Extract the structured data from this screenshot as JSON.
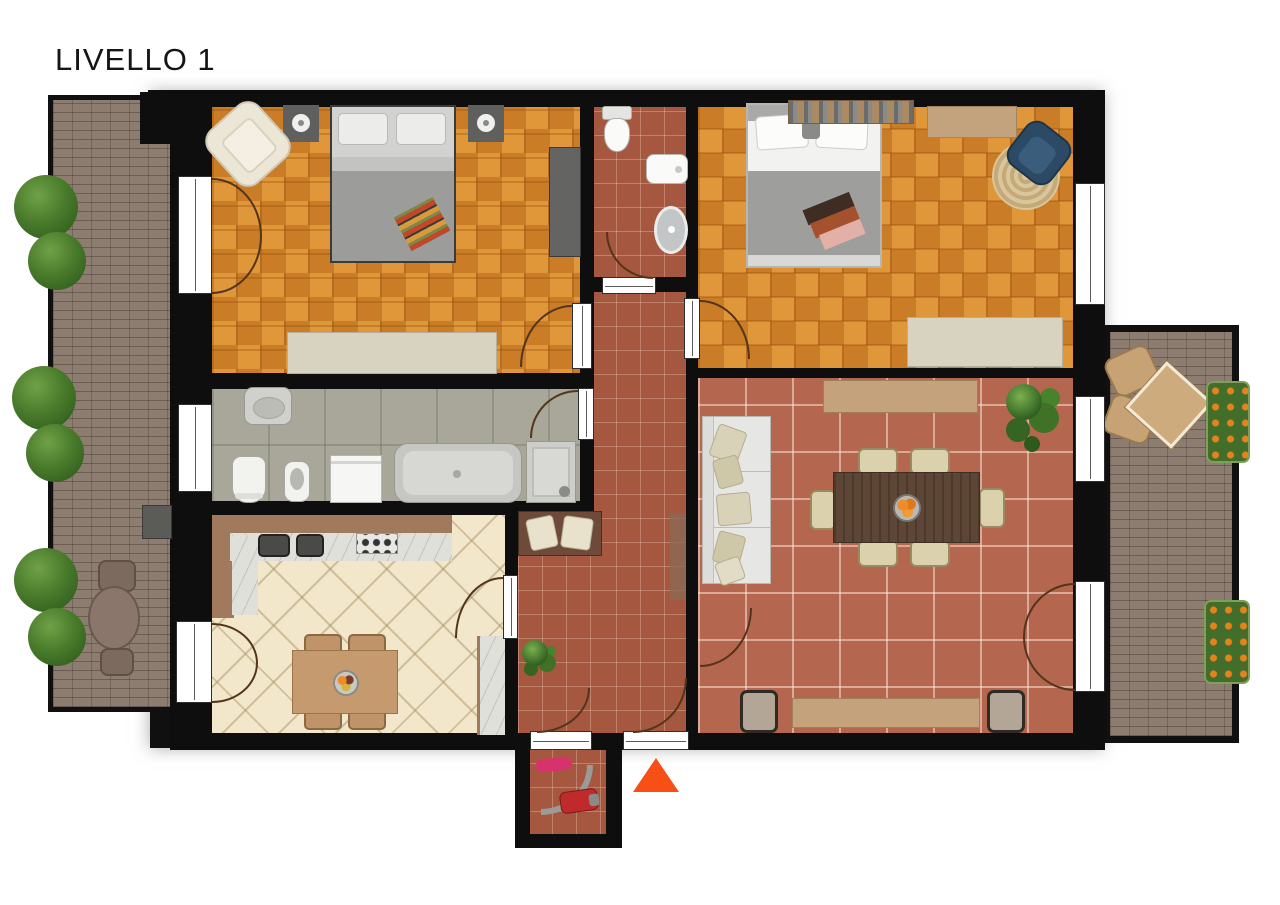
{
  "title": "LIVELLO 1",
  "colors": {
    "wall": "#0e0e0e",
    "parquet": "#d6882e",
    "tile-red": "#a5573f",
    "tile-terra": "#b4664e",
    "tile-bath": "#a8a79a",
    "tile-kitchen": "#f2e7cb",
    "brick": "#8d7d71",
    "marker": "#f84f16",
    "wood-dark": "#5d4636",
    "wood-mid": "#c09468",
    "sideboard-tan": "#c4a27c",
    "sofa-cream": "#e6e6e4"
  }
}
